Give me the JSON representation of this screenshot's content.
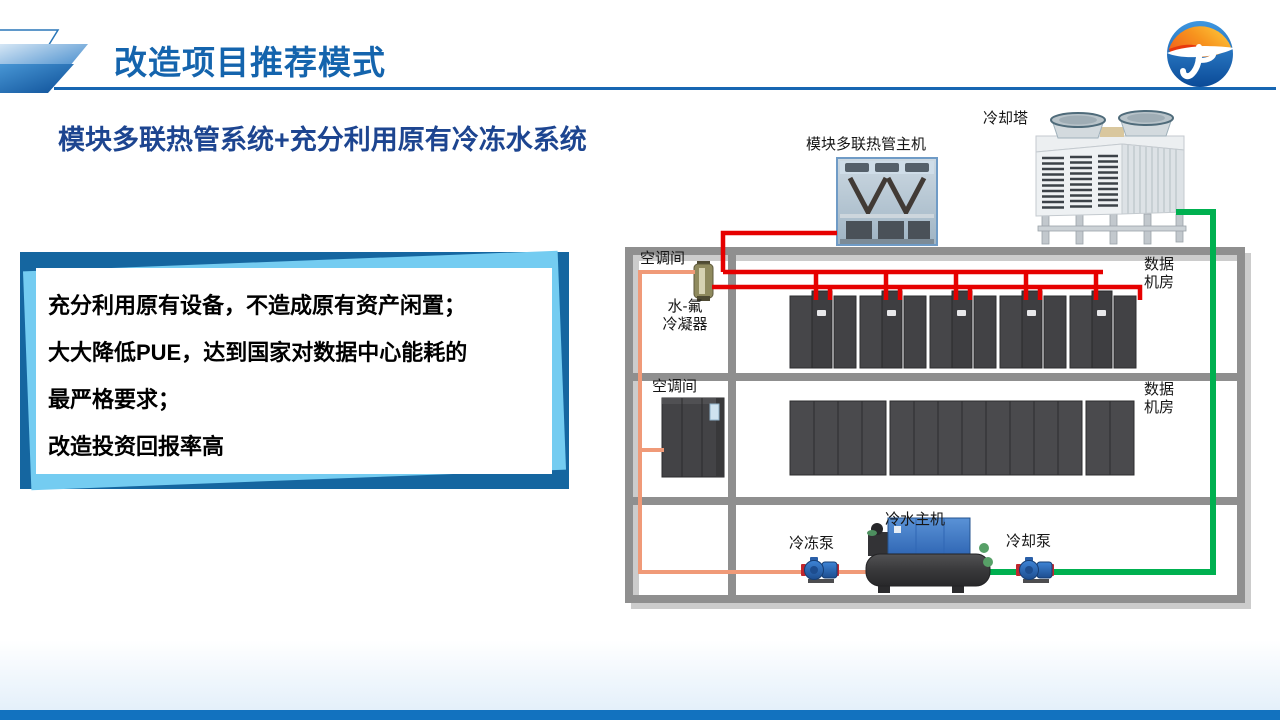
{
  "slide": {
    "title": "改造项目推荐模式",
    "subtitle": "模块多联热管系统+充分利用原有冷冻水系统",
    "info_box": {
      "lines": [
        "充分利用原有设备，不造成原有资产闲置；",
        "大大降低PUE，达到国家对数据中心能耗的",
        "最严格要求；",
        "改造投资回报率高"
      ]
    },
    "diagram": {
      "unit_photo_label": "模块多联热管主机",
      "cooling_tower_label": "冷却塔",
      "ac_room1_label": "空调间",
      "condenser_label": "水-氟\n冷凝器",
      "data_room1_label": "数据\n机房",
      "ac_room2_label": "空调间",
      "data_room2_label": "数据\n机房",
      "chilled_pump_label": "冷冻泵",
      "chiller_label": "冷水主机",
      "cooling_pump_label": "冷却泵"
    },
    "colors": {
      "title_blue": "#1464ad",
      "subtitle_blue": "#1d4590",
      "box_dark_blue": "#1566a0",
      "box_light_blue": "#74ccf1",
      "wall_gray": "#8f8f8f",
      "red_pipe": "#e60000",
      "orange_pipe": "#f09a78",
      "green_pipe": "#00b050",
      "footer_blue": "#1272bf"
    }
  }
}
